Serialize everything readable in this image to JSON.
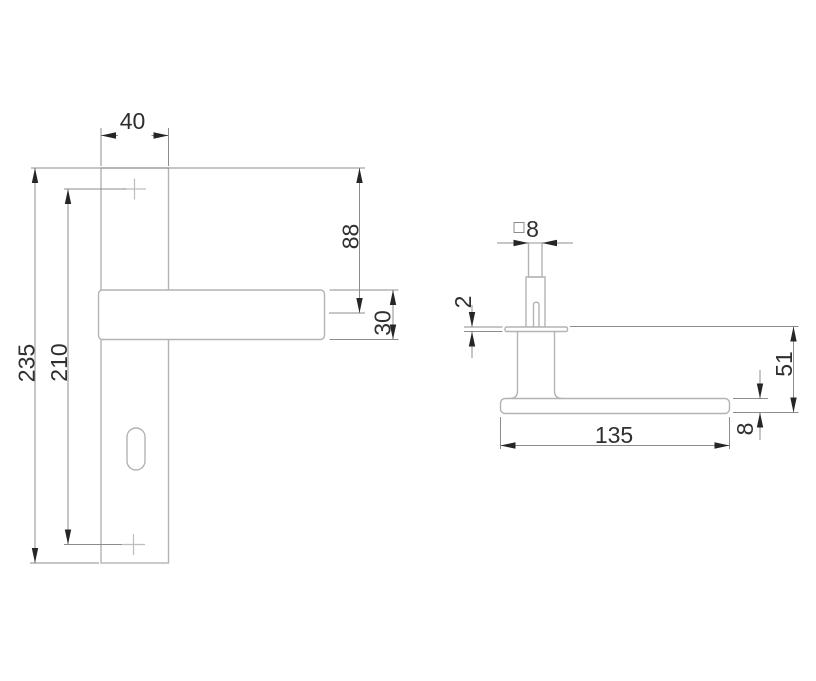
{
  "front_view": {
    "dimensions": {
      "plate_width": "40",
      "plate_height": "235",
      "screw_spacing": "210",
      "top_to_lever": "88",
      "lever_height": "30"
    }
  },
  "side_view": {
    "dimensions": {
      "spindle_size": "8",
      "rosette_thickness": "2",
      "projection": "51",
      "lever_length": "135",
      "lever_thickness": "8"
    }
  },
  "colors": {
    "outline": "#b1b3b5",
    "cross": "#bcbec0",
    "dimension_line": "#8a8c8f",
    "arrow": "#262628",
    "text": "#2f2f31"
  }
}
